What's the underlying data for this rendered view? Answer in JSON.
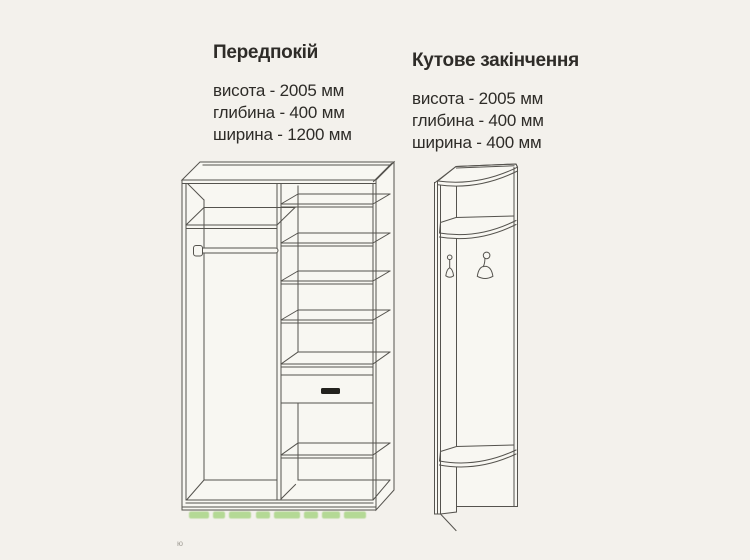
{
  "page": {
    "colors": {
      "bg": "#f3f1ec",
      "line": "#55534e",
      "text": "#2e2c28",
      "face": "#f8f7f2",
      "wm": "#76c13e"
    }
  },
  "products": [
    {
      "id": "hallway-wardrobe",
      "title": "Передпокій",
      "specs": [
        "висота - 2005 мм",
        "глибина - 400 мм",
        "ширина - 1200 мм"
      ]
    },
    {
      "id": "corner-end-unit",
      "title": "Кутове закінчення",
      "specs": [
        "висота - 2005 мм",
        "глибина - 400 мм",
        "ширина - 400 мм"
      ]
    }
  ],
  "footnote": "ю"
}
